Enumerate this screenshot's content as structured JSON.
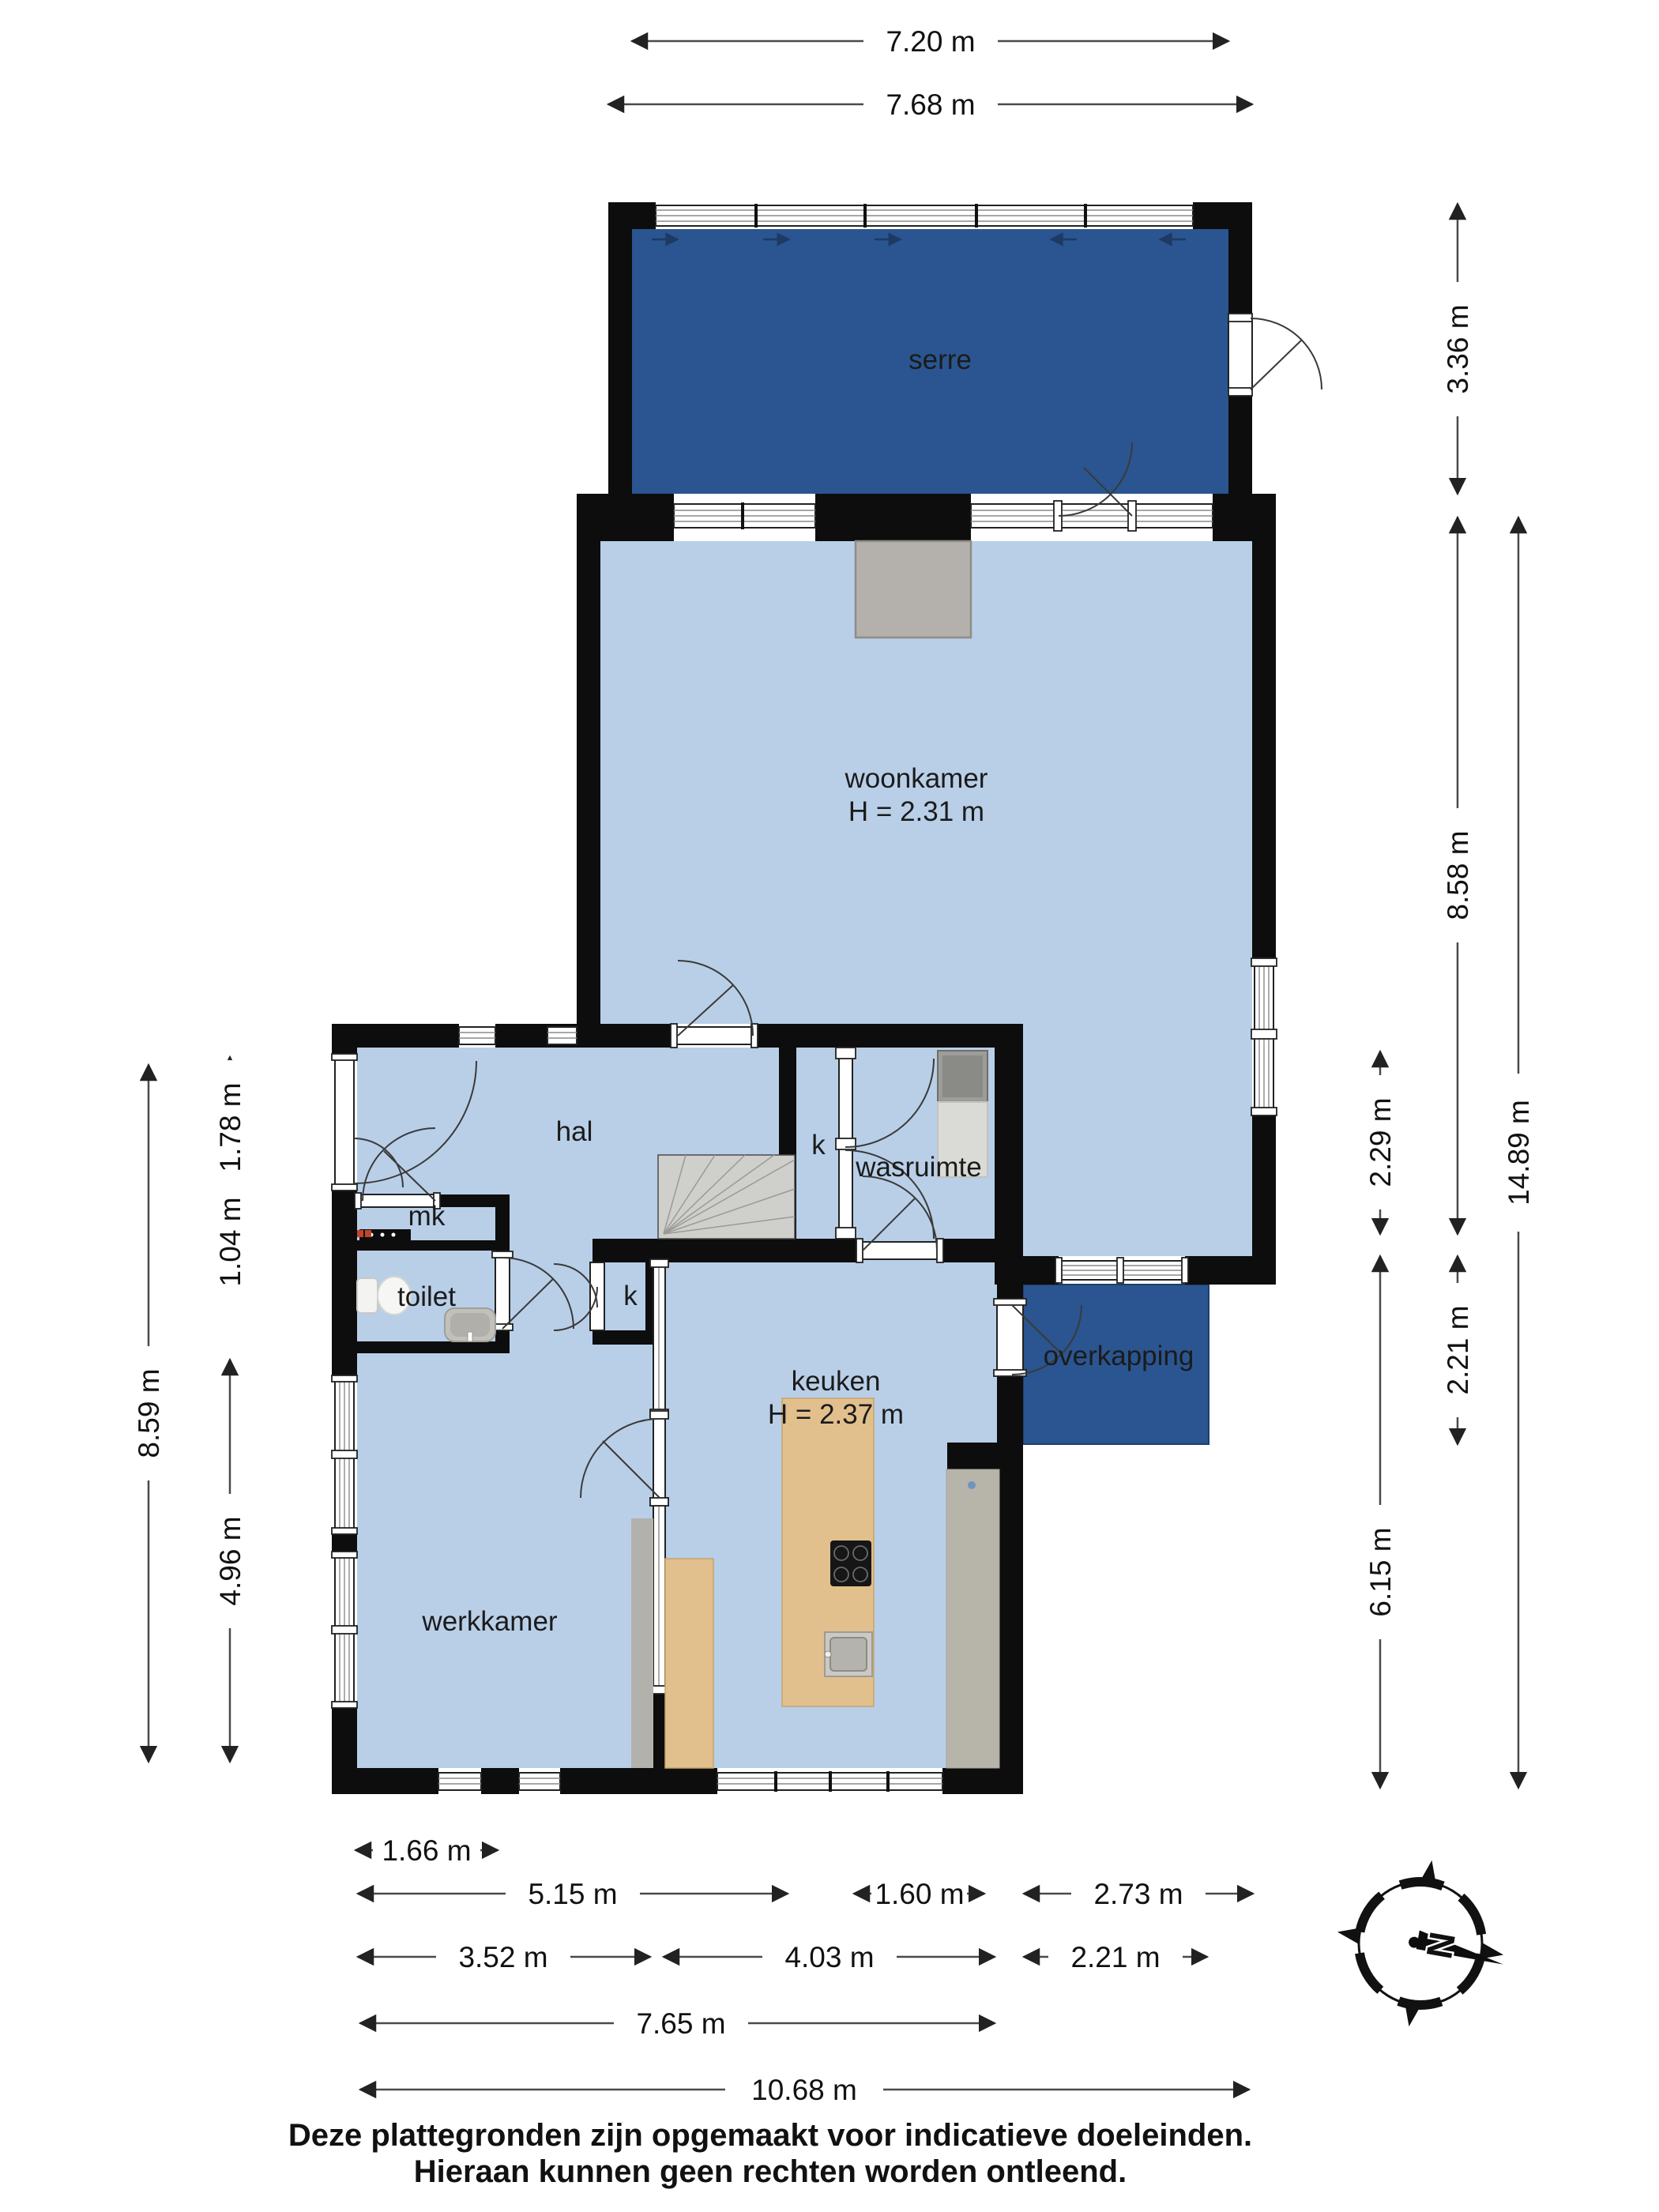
{
  "rooms": {
    "serre": {
      "label": "serre"
    },
    "woonkamer": {
      "label": "woonkamer",
      "height": "H = 2.31 m"
    },
    "hal": {
      "label": "hal"
    },
    "closet_upper": {
      "label": "k"
    },
    "closet_lower": {
      "label": "k"
    },
    "wasruimte": {
      "label": "wasruimte"
    },
    "mk": {
      "label": "mk"
    },
    "toilet": {
      "label": "toilet"
    },
    "keuken": {
      "label": "keuken",
      "height": "H = 2.37 m"
    },
    "werkkamer": {
      "label": "werkkamer"
    },
    "overkapping": {
      "label": "overkapping"
    }
  },
  "dimensions": {
    "top": {
      "d720": "7.20 m",
      "d768": "7.68 m"
    },
    "left": {
      "d859": "8.59 m",
      "d178": "1.78 m",
      "d104": "1.04 m",
      "d496": "4.96 m"
    },
    "right": {
      "d336": "3.36 m",
      "d858": "8.58 m",
      "d229": "2.29 m",
      "d221": "2.21 m",
      "d615": "6.15 m",
      "d1489": "14.89 m"
    },
    "bottom": {
      "d166": "1.66 m",
      "d515": "5.15 m",
      "d160": "1.60 m",
      "d273": "2.73 m",
      "d352": "3.52 m",
      "d403": "4.03 m",
      "d221b": "2.21 m",
      "d765": "7.65 m",
      "d1068": "10.68 m"
    }
  },
  "compass": {
    "north": "N"
  },
  "disclaimer": {
    "line1": "Deze plattegronden zijn opgemaakt voor indicatieve doeleinden.",
    "line2": "Hieraan kunnen geen rechten worden ontleend."
  },
  "colors": {
    "accent_dark_blue": "#2a5590",
    "room_light_blue": "#b9cfe8",
    "wall_black": "#0d0d0d",
    "wood": "#e2c08d",
    "gray_furniture": "#b7b4aa"
  }
}
